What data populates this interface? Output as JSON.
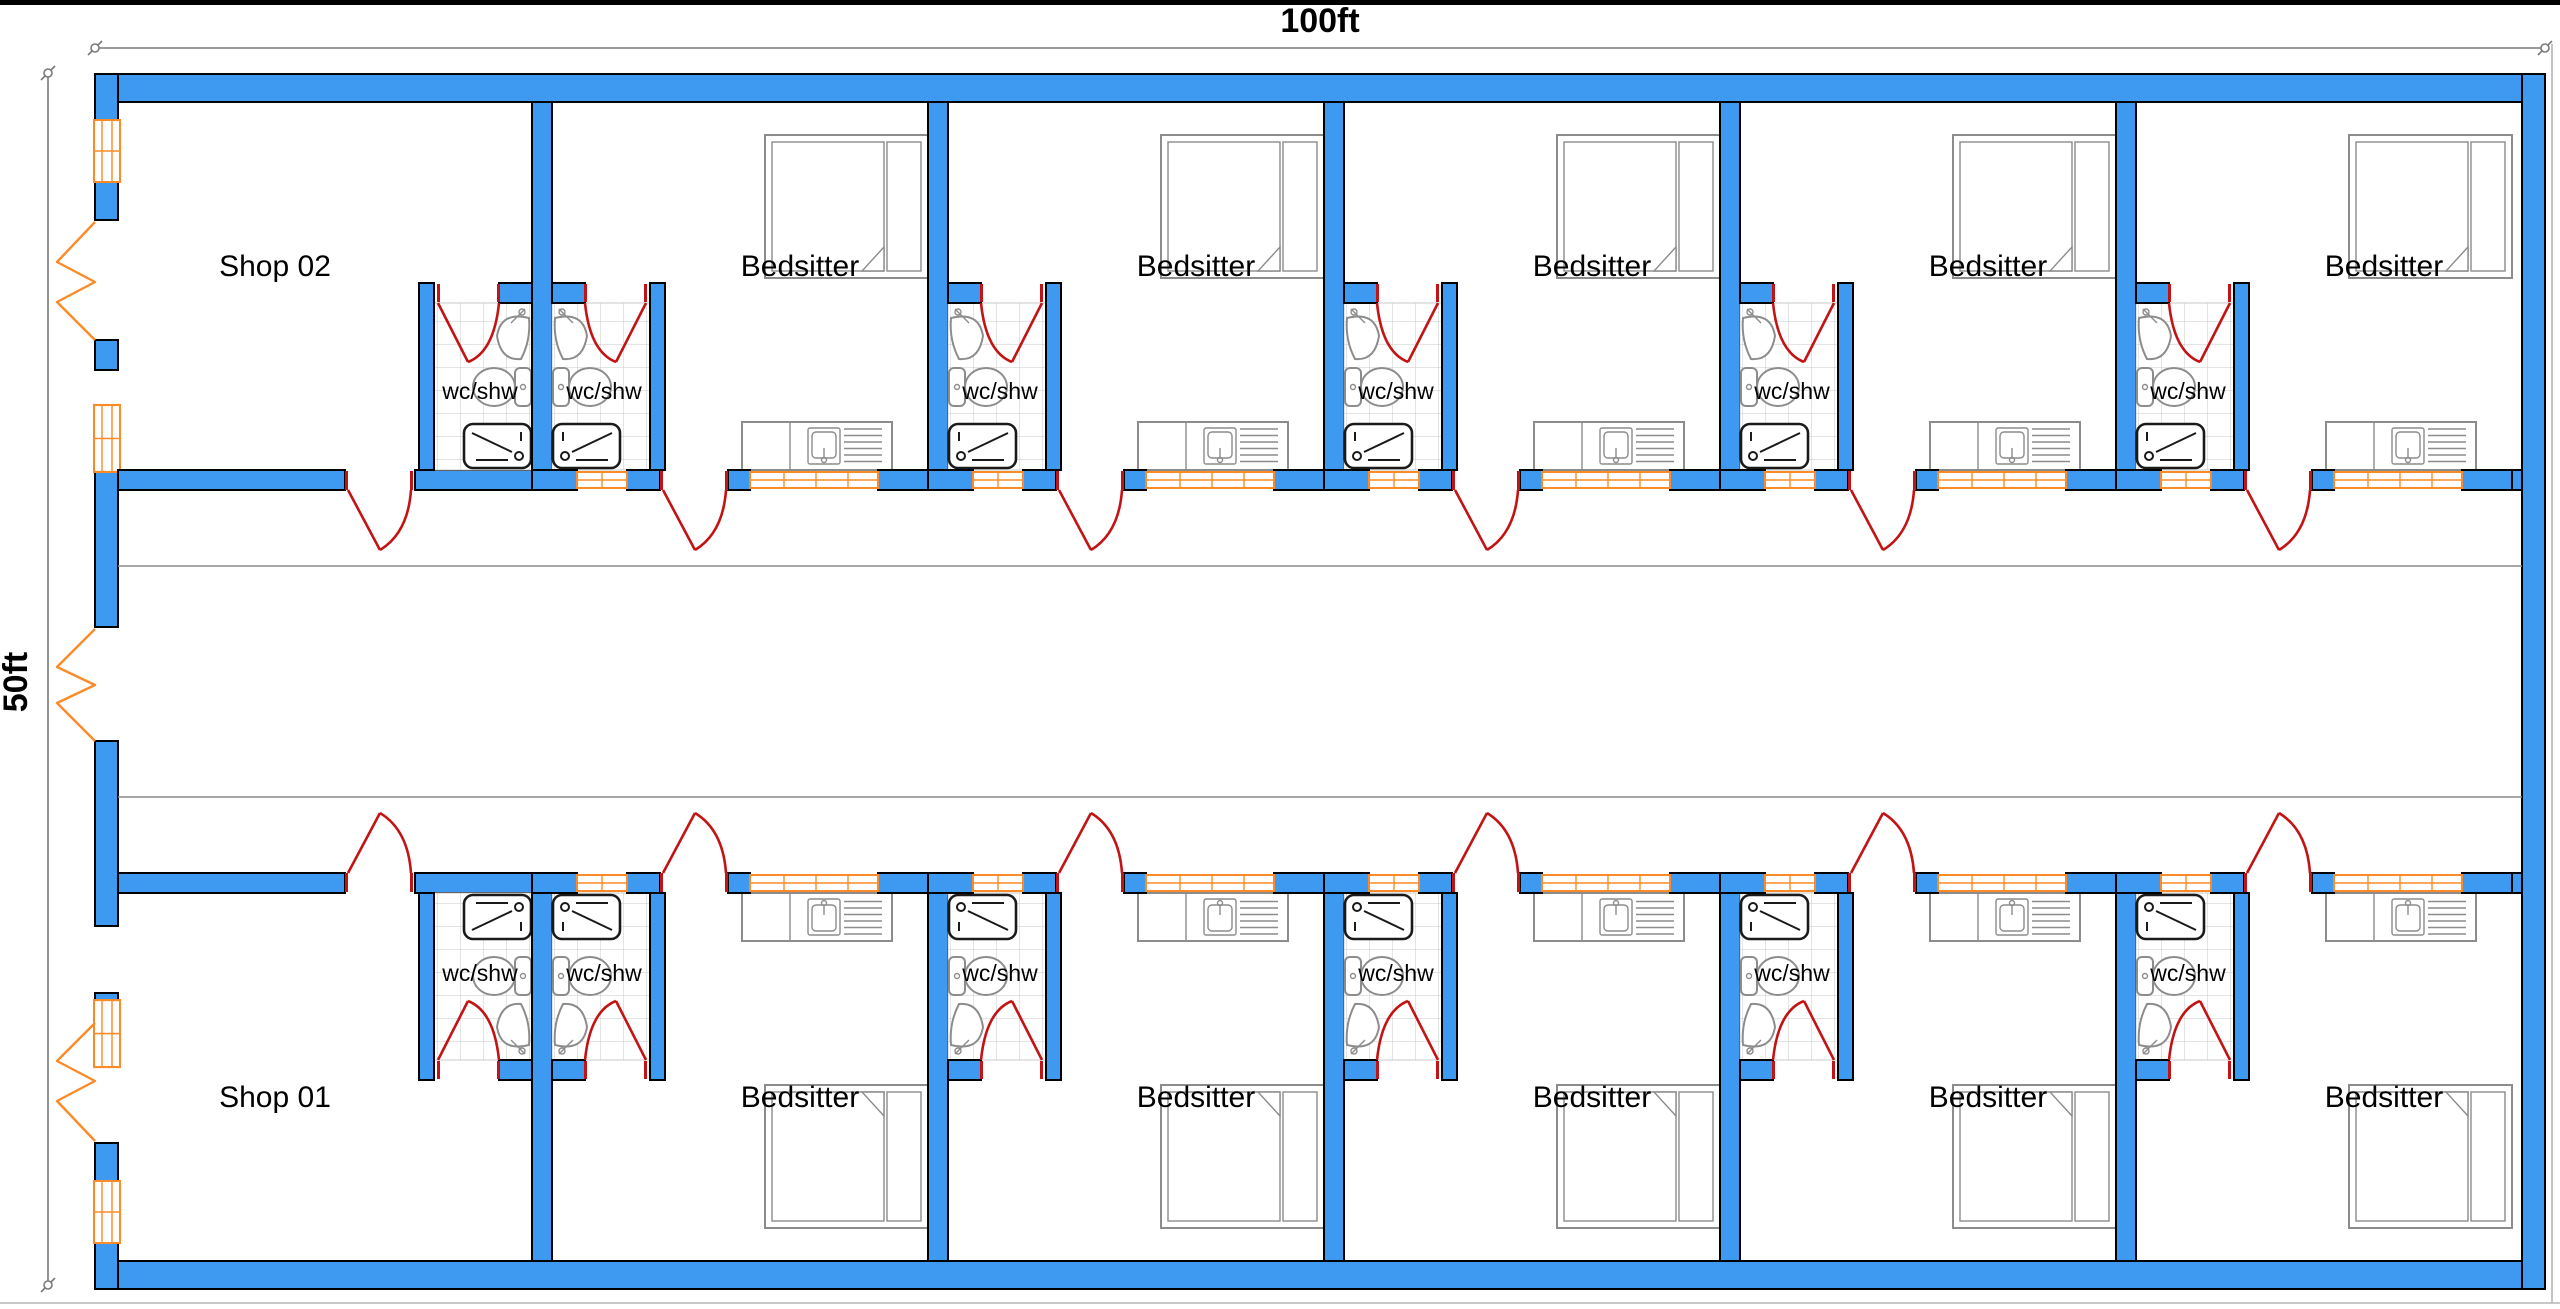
{
  "plan": {
    "dimension_width_label": "100ft",
    "dimension_height_label": "50ft",
    "bathroom_label": "wc/shw",
    "rows": {
      "top": {
        "units": [
          "Shop 02",
          "Bedsitter",
          "Bedsitter",
          "Bedsitter",
          "Bedsitter",
          "Bedsitter"
        ]
      },
      "bottom": {
        "units": [
          "Shop 01",
          "Bedsitter",
          "Bedsitter",
          "Bedsitter",
          "Bedsitter",
          "Bedsitter"
        ]
      }
    },
    "bathroom_count": 12,
    "colors": {
      "wall_fill": "#3E9AF0",
      "wall_outline": "#000000",
      "door_swing": "#C21414",
      "window_frame": "#FB8B28",
      "tile_grid": "#c8c8c8",
      "fixture_outline": "#8C8C8C",
      "dimension_line": "#7a7a7a",
      "text": "#000000",
      "background": "#ffffff"
    }
  }
}
